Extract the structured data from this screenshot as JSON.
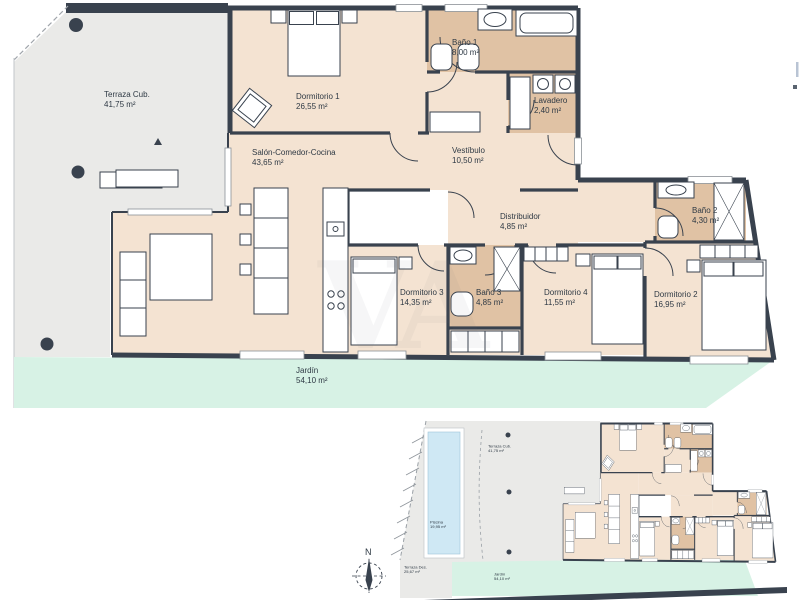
{
  "main_plan": {
    "rooms": [
      {
        "id": "terraza",
        "name": "Terraza Cub.",
        "area": "41,75 m²"
      },
      {
        "id": "dormitorio-1",
        "name": "Dormitorio 1",
        "area": "26,55 m²"
      },
      {
        "id": "bano-1",
        "name": "Baño 1",
        "area": "8,00 m²"
      },
      {
        "id": "lavadero",
        "name": "Lavadero",
        "area": "2,40 m²"
      },
      {
        "id": "salon",
        "name": "Salón-Comedor-Cocina",
        "area": "43,65 m²"
      },
      {
        "id": "vestibulo",
        "name": "Vestíbulo",
        "area": "10,50 m²"
      },
      {
        "id": "distribuidor",
        "name": "Distribuidor",
        "area": "4,85 m²"
      },
      {
        "id": "bano-2",
        "name": "Baño 2",
        "area": "4,30 m²"
      },
      {
        "id": "dormitorio-3",
        "name": "Dormitorio 3",
        "area": "14,35 m²"
      },
      {
        "id": "bano-3",
        "name": "Baño 3",
        "area": "4,85 m²"
      },
      {
        "id": "dormitorio-4",
        "name": "Dormitorio 4",
        "area": "11,55 m²"
      },
      {
        "id": "dormitorio-2",
        "name": "Dormitorio 2",
        "area": "16,95 m²"
      },
      {
        "id": "jardin",
        "name": "Jardín",
        "area": "54,10 m²"
      }
    ]
  },
  "mini_plan": {
    "labels": [
      {
        "id": "terraza-cub",
        "name": "Terraza Cub.",
        "area": "41,75 m²"
      },
      {
        "id": "piscina",
        "name": "Piscina",
        "area": "19,95 m²"
      },
      {
        "id": "terraza-des",
        "name": "Terraza Des.",
        "area": "25,67 m²"
      },
      {
        "id": "jardin",
        "name": "Jardín",
        "area": "54,10 m²"
      }
    ]
  },
  "compass": {
    "north": "N"
  },
  "watermark": {
    "text": "VA"
  },
  "colors": {
    "wall": "#39424e",
    "room_fill": "#f4e3d2",
    "wet_room_fill": "#e0c2a4",
    "terrace_fill": "#eaeae8",
    "garden_fill": "#d7f2e5",
    "pool_fill": "#cfe8f4",
    "label_text": "#2e3944"
  }
}
